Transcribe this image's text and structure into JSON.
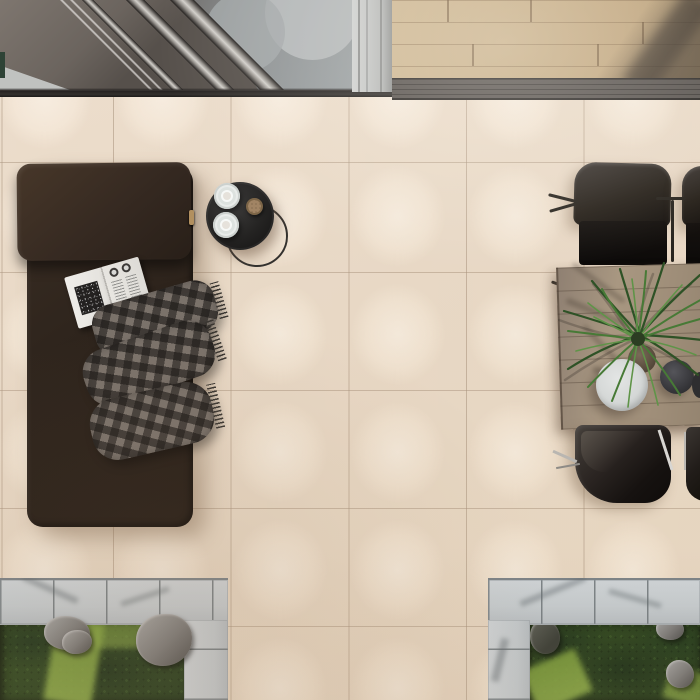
{
  "meta": {
    "description": "Top-down 3D interior/exterior render: cream porcelain tile patio with daybed, side table, dining set and sunken garden beds",
    "view": "top-down",
    "canvas": "700x700"
  },
  "palette": {
    "tile": "#efe1d0",
    "grout": "#a8927c",
    "wood_floor": "#c2a87f",
    "threshold": "#57524e",
    "glass_door": "#9aa0a2",
    "daybed_leather": "#2f251d",
    "blanket_gray": "#6b635c",
    "tray_table": "#242322",
    "dining_wood": "#a89781",
    "chair_shell": "#262019",
    "paver": "#c9ced1",
    "foliage_dark": "#243a1a",
    "moss_light": "#8fae46",
    "rock_gray": "#7b7a78"
  },
  "scene": {
    "objects": {
      "glass_door": "sliding glass door with aluminum tracks",
      "wood_floor": "indoor oak plank flooring",
      "threshold": "dark metal door threshold track",
      "tile_floor": "cream porcelain patio tiles",
      "daybed": "dark brown leather daybed with headrest cushion",
      "magazine": "open magazine with black-and-white spread",
      "blanket": "gray plaid throw blanket with fringe",
      "side_table": "round black tray side table with wire base",
      "cup": "white cup on saucer",
      "snack": "small round snack dish",
      "dining_table": "rectangular wooden dining table",
      "dining_chair": "dark shell dining chair with metal frame",
      "palm_plant": "potted palm plant centerpiece",
      "white_planter": "round white planter",
      "dark_bowl": "dark gray bowl",
      "garden_left": "sunken garden bed with paver border, moss and rocks",
      "garden_right": "sunken garden bed with paver border, shrubs and rocks"
    }
  }
}
